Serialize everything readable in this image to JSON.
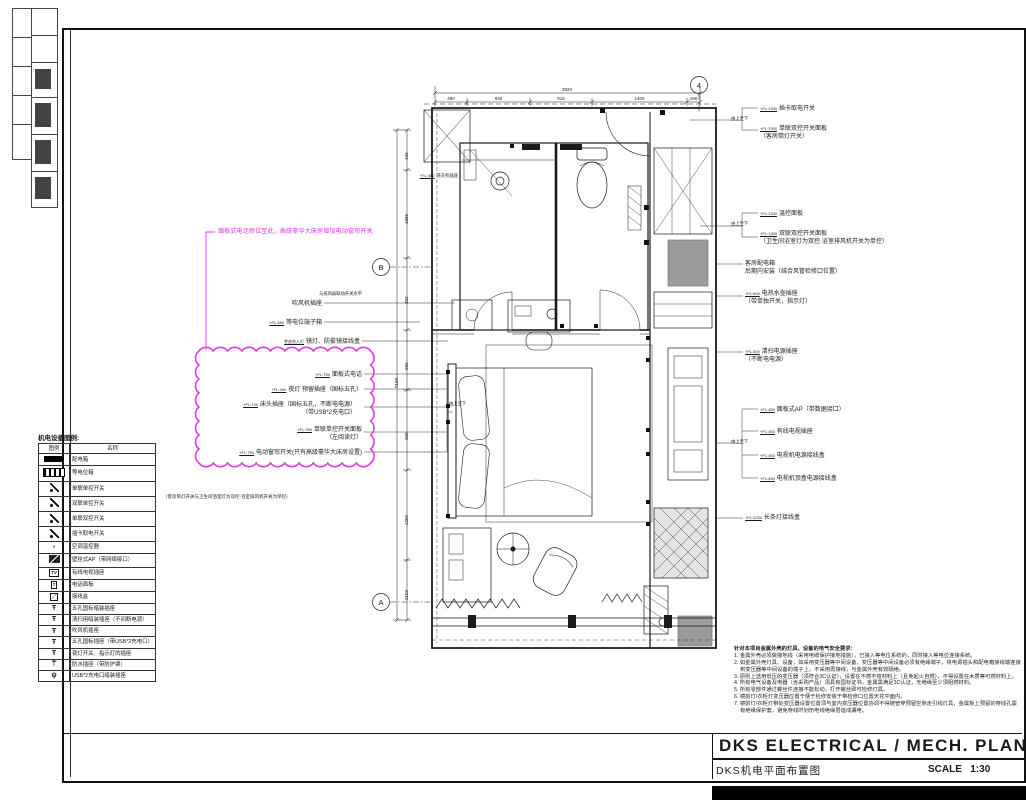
{
  "sheet": {
    "title_en": "DKS ELECTRICAL / MECH. PLAN",
    "title_cn": "DKS机电平面布置图",
    "scale_label": "SCALE",
    "scale_value": "1:30"
  },
  "colors": {
    "line": "#1a1a1a",
    "revision_magenta": "#e03ce8",
    "fill_gray": "#9b9b9b"
  },
  "grid_bubbles": [
    {
      "label": "4",
      "x": 699,
      "y": 85
    },
    {
      "label": "B",
      "x": 381,
      "y": 267
    },
    {
      "label": "A",
      "x": 381,
      "y": 602
    }
  ],
  "dimensions": {
    "top_total": "3920",
    "top_segments": [
      "480",
      "935",
      "915",
      "1400",
      "190"
    ],
    "left_total": "7150",
    "left_segments": [
      "420",
      "1865",
      "302",
      "950",
      "260",
      "1250",
      "2103"
    ]
  },
  "legend": {
    "title": "机电设备图例:",
    "col_symbol": "图例",
    "col_name": "名称",
    "side_note": "（客房筒灯开关与卫生间浴室灯为双控·浴室排风机开关为单控）",
    "rows": [
      {
        "sym": "bar",
        "glyph": "",
        "name": "配电箱"
      },
      {
        "sym": "leb",
        "glyph": "",
        "name": "等电位箱"
      },
      {
        "sym": "sw",
        "glyph": "",
        "name": "单联单控开关"
      },
      {
        "sym": "sw",
        "glyph": "",
        "name": "双联单控开关"
      },
      {
        "sym": "sw",
        "glyph": "",
        "name": "单联双控开关"
      },
      {
        "sym": "sw",
        "glyph": "",
        "name": "插卡取电开关"
      },
      {
        "sym": "glyph",
        "glyph": "♀",
        "name": "空调温控器"
      },
      {
        "sym": "ap",
        "glyph": "",
        "name": "壁挂式AP（带网络接口）"
      },
      {
        "sym": "box",
        "glyph": "TV",
        "name": "有线电视插座"
      },
      {
        "sym": "box",
        "glyph": "T",
        "name": "电话面板"
      },
      {
        "sym": "box",
        "glyph": "／",
        "name": "接线盒"
      },
      {
        "sym": "glyph",
        "glyph": "Ŧ",
        "name": "五孔国标暗装插座"
      },
      {
        "sym": "glyph",
        "glyph": "Ŧ",
        "name": "清扫用暗装插座（不间断电源）"
      },
      {
        "sym": "glyph",
        "glyph": "Ŧ",
        "name": "吹风机插座"
      },
      {
        "sym": "glyph",
        "glyph": "Ŧ",
        "name": "五孔国标插座（带USB*2充电口）"
      },
      {
        "sym": "glyph",
        "glyph": "Ŧ",
        "name": "夜灯开关、指示灯的插座"
      },
      {
        "sym": "glyph",
        "glyph": "⍑",
        "name": "防水插座（带防护罩）"
      },
      {
        "sym": "glyph",
        "glyph": "ψ",
        "name": "USB*2充电口暗装插座"
      }
    ]
  },
  "cloud_note": {
    "text": "面板式电话移位至此，高级豪华大床房增加电动窗帘开关",
    "color": "#e03ce8"
  },
  "annotations": [
    {
      "x": 362,
      "y": 291,
      "align": "right",
      "size": 4.3,
      "lines": [
        "与排风扇联动开关水平"
      ]
    },
    {
      "x": 322,
      "y": 301,
      "align": "right",
      "size": 6,
      "lines": [
        "吹风机插座"
      ]
    },
    {
      "x": 322,
      "y": 320,
      "align": "right",
      "size": 6,
      "elev": "+FL:380",
      "lines": [
        "等电位端子箱"
      ]
    },
    {
      "x": 360,
      "y": 339,
      "align": "right",
      "size": 6,
      "elev": "考虑合入灯",
      "lines": [
        "镜灯、防雾镜接线盒"
      ]
    },
    {
      "x": 362,
      "y": 372,
      "align": "right",
      "size": 6,
      "elev": "+FL:750",
      "lines": [
        "面板式电话"
      ]
    },
    {
      "x": 362,
      "y": 387,
      "align": "right",
      "size": 6,
      "elev": "+FL:300",
      "lines": [
        "夜灯 预留插座（国标五孔）"
      ]
    },
    {
      "x": 356,
      "y": 402,
      "align": "right",
      "size": 6,
      "elev": "+FL:740",
      "lines": [
        "床头插座（国标五孔，不断电电源）",
        "（带USB*2充电口）"
      ]
    },
    {
      "x": 362,
      "y": 427,
      "align": "right",
      "size": 6,
      "elev": "+FL:750",
      "lines": [
        "单联单控开关面板",
        "（左阅读灯）"
      ]
    },
    {
      "x": 362,
      "y": 450,
      "align": "right",
      "size": 6,
      "elev": "+FL:750",
      "lines": [
        "电动窗帘开关(只有高级豪华大床房设置)"
      ]
    },
    {
      "x": 458,
      "y": 173,
      "align": "right",
      "size": 4.3,
      "elev": "+FL:400",
      "lines": [
        "洗衣机插座"
      ]
    },
    {
      "x": 449,
      "y": 401,
      "align": "left",
      "size": 4.3,
      "lines": [
        "由上至下"
      ]
    },
    {
      "x": 760,
      "y": 106,
      "align": "left",
      "size": 6,
      "elev": "+FL:1300",
      "lines": [
        "插卡取电开关"
      ]
    },
    {
      "x": 760,
      "y": 126,
      "align": "left",
      "size": 6,
      "elev": "+FL:1300",
      "lines": [
        "单联双控开关面板",
        "（客房筒灯开关）"
      ]
    },
    {
      "x": 731,
      "y": 116,
      "align": "left",
      "size": 4.3,
      "lines": [
        "由上至下"
      ]
    },
    {
      "x": 760,
      "y": 211,
      "align": "left",
      "size": 6,
      "elev": "+FL:1300",
      "lines": [
        "温控面板"
      ]
    },
    {
      "x": 760,
      "y": 231,
      "align": "left",
      "size": 6,
      "elev": "+FL:1300",
      "lines": [
        "双联双控开关面板",
        "（卫生间浴室灯为双控·浴室排风机开关为单控）"
      ]
    },
    {
      "x": 731,
      "y": 221,
      "align": "left",
      "size": 4.3,
      "lines": [
        "由上至下"
      ]
    },
    {
      "x": 745,
      "y": 261,
      "align": "left",
      "size": 6,
      "lines": [
        "客房配电箱",
        "后期内安装（结合风管检修口位置）"
      ]
    },
    {
      "x": 745,
      "y": 291,
      "align": "left",
      "size": 6,
      "elev": "+FL:900",
      "lines": [
        "电热水壶插座",
        "（带单独开关，指示灯）"
      ]
    },
    {
      "x": 745,
      "y": 349,
      "align": "left",
      "size": 6,
      "elev": "+FL:300",
      "lines": [
        "清扫电源插座",
        "（不断电电源）"
      ]
    },
    {
      "x": 760,
      "y": 407,
      "align": "left",
      "size": 6,
      "elev": "+FL:450",
      "lines": [
        "面板式AP（带数据接口）"
      ]
    },
    {
      "x": 760,
      "y": 429,
      "align": "left",
      "size": 6,
      "elev": "+FL:450",
      "lines": [
        "有线电视插座"
      ]
    },
    {
      "x": 731,
      "y": 439,
      "align": "left",
      "size": 4.3,
      "lines": [
        "由上至下"
      ]
    },
    {
      "x": 760,
      "y": 453,
      "align": "left",
      "size": 6,
      "elev": "+FL:450",
      "lines": [
        "电视机电源接线盒"
      ]
    },
    {
      "x": 760,
      "y": 476,
      "align": "left",
      "size": 6,
      "elev": "+FL:450",
      "lines": [
        "电视机顶盒电源接线盒"
      ]
    },
    {
      "x": 745,
      "y": 515,
      "align": "left",
      "size": 6,
      "elev": "+FL:2200",
      "lines": [
        "长条灯接线盒"
      ]
    },
    {
      "x": 163,
      "y": 494,
      "align": "left",
      "size": 4.5,
      "w": 172,
      "lines": [
        "（客房筒灯开关与卫生间浴室灯为双控·浴室排风机开关为单控）"
      ]
    }
  ],
  "notes": {
    "title": "针对本项目金属外壳的灯具、设备的电气安全要求：",
    "items": [
      "1. 金属外壳必须做接地线（采用电缆保护接地措施），已接入等电位系统的，同时接入等电位连接系统。",
      "2. 如金属外壳灯具、设备，如采用变压器等中间设备，变压器等中间设备必须有绝缘端子，将电源插头和配电箱接线端连接到变压器等中间设备的端子上，不采用再接线，与金属外壳有效隔绝。",
      "3. 原则上选用低压的变压器（须符合3C认证），设置在不燃不熔材料上（且免起火自燃），不得设置在木质等可燃材料上。",
      "4. 所有电气设备及电器（含采购产品）须具有国标证书，金属需满足3C认证，无绝缘至少须阻燃材料。",
      "5. 所有零部件通过螺丝件连接不能松动，打开螺丝即可检修灯具。",
      "6. 镜前灯/衣柜灯变压器应置于便于检修安装于带检修口位置天花平面内。",
      "7. 镜前灯/衣柜灯带处变压器设置位置须与室内变压器位置协调不得随管穿预留空隙走引线灯具，金属板上预留的穿线孔需有绝缘保护套，避免穿线时划伤电线绝缘层造成漏电。"
    ]
  }
}
